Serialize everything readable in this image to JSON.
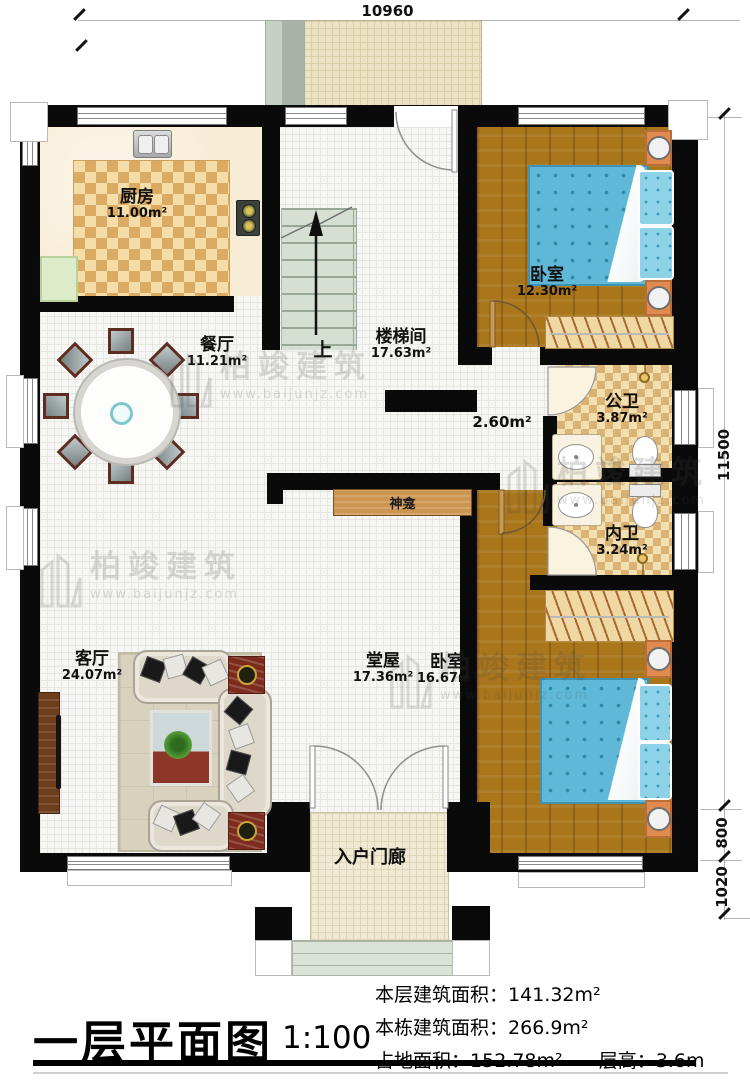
{
  "plan": {
    "title": "一层平面图",
    "scale": "1:100",
    "stats": {
      "floor_area_label": "本层建筑面积：",
      "floor_area_value": "141.32m²",
      "building_area_label": "本栋建筑面积：",
      "building_area_value": "266.9m²",
      "land_area_label": "占地面积：",
      "land_area_value": "152.78m²",
      "height_label": "层高：",
      "height_value": "3.6m"
    },
    "dimensions": {
      "top_width": "10960",
      "right_total": "11500",
      "right_porch": "800",
      "right_steps": "1020"
    },
    "rooms": {
      "kitchen": {
        "name": "厨房",
        "area": "11.00m²"
      },
      "dining": {
        "name": "餐厅",
        "area": "11.21m²"
      },
      "stairwell": {
        "name": "楼梯间",
        "area": "17.63m²"
      },
      "bedroom_top": {
        "name": "卧室",
        "area": "12.30m²"
      },
      "corridor": {
        "area": "2.60m²"
      },
      "public_bath": {
        "name": "公卫",
        "area": "3.87m²"
      },
      "private_bath": {
        "name": "内卫",
        "area": "3.24m²"
      },
      "living": {
        "name": "客厅",
        "area": "24.07m²"
      },
      "hall": {
        "name": "堂屋",
        "area": "17.36m²"
      },
      "bedroom_bottom": {
        "name": "卧室",
        "area": "16.67m²"
      },
      "porch": {
        "name": "入户门廊"
      },
      "shrine": {
        "name": "神龛"
      },
      "stairs": {
        "up": "上"
      }
    },
    "watermark": {
      "name": "柏竣建筑",
      "url": "www.baijunjz.com"
    },
    "colors": {
      "wall": "#0a0a0a",
      "wood": "#a9761c",
      "bed_blue": "#5fb8d8",
      "bath_tile": "#d9b274",
      "nightstand": "#e08a50"
    }
  }
}
